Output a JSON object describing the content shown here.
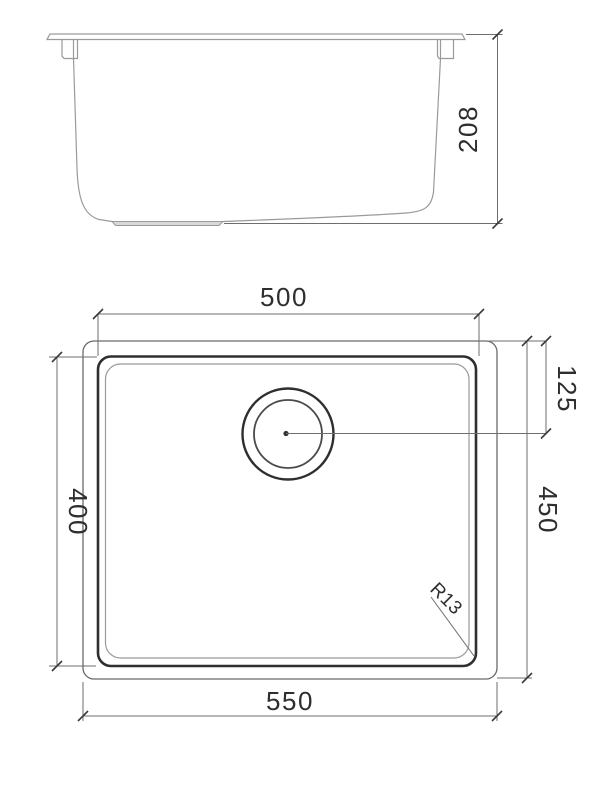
{
  "drawing": {
    "title": "sink-technical-drawing",
    "side_view": {
      "depth_label": "208"
    },
    "plan_view": {
      "inner_width_label": "500",
      "drain_offset_label": "125",
      "inner_length_label": "400",
      "outer_length_label": "450",
      "outer_width_label": "550",
      "corner_radius_label": "R13"
    },
    "colors": {
      "line_dark": "#2f2f2f",
      "line_mid": "#6a6a6a",
      "line_light": "#9a9a9a",
      "dim": "#6e6e6e",
      "text": "#2e2e2e",
      "background": "#ffffff"
    }
  }
}
